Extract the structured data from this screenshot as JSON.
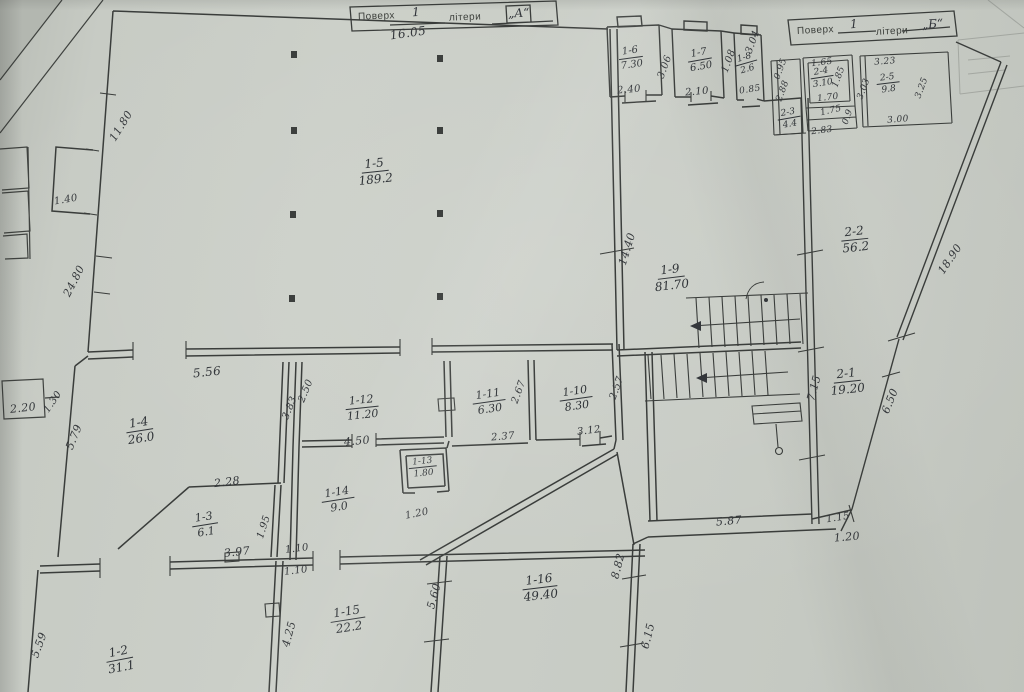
{
  "meta": {
    "document_type": "scanned floor plan",
    "paper_color": "#c9cdc6",
    "ink_color": "#34373b"
  },
  "title_blocks": [
    {
      "floor_label": "Поверх",
      "floor_value": "1",
      "letter_label": "літери",
      "letter_value": "„А“"
    },
    {
      "floor_label": "Поверх",
      "floor_value": "1",
      "letter_label": "літери",
      "letter_value": "„Б“"
    }
  ],
  "rooms": [
    {
      "id": "1-5",
      "area": "189.2",
      "x": 375,
      "y": 172,
      "rot": -6,
      "fs": 12
    },
    {
      "id": "1-6",
      "area": "7.30",
      "x": 631,
      "y": 58,
      "rot": -8,
      "fs": 10
    },
    {
      "id": "1-7",
      "area": "6.50",
      "x": 700,
      "y": 60,
      "rot": -10,
      "fs": 10
    },
    {
      "id": "1-8",
      "area": "2.6",
      "x": 746,
      "y": 64,
      "rot": -16,
      "fs": 9
    },
    {
      "id": "1-9",
      "area": "81.70",
      "x": 671,
      "y": 278,
      "rot": -7,
      "fs": 12
    },
    {
      "id": "2-2",
      "area": "56.2",
      "x": 855,
      "y": 240,
      "rot": -6,
      "fs": 12
    },
    {
      "id": "2-1",
      "area": "19.20",
      "x": 847,
      "y": 382,
      "rot": -6,
      "fs": 12
    },
    {
      "id": "2-3",
      "area": "4.4",
      "x": 789,
      "y": 119,
      "rot": -10,
      "fs": 9
    },
    {
      "id": "2-4",
      "area": "3.10",
      "x": 822,
      "y": 78,
      "rot": -9,
      "fs": 9
    },
    {
      "id": "2-5",
      "area": "9.8",
      "x": 888,
      "y": 84,
      "rot": -7,
      "fs": 9
    },
    {
      "id": "1-4",
      "area": "26.0",
      "x": 140,
      "y": 431,
      "rot": -9,
      "fs": 12
    },
    {
      "id": "1-12",
      "area": "11.20",
      "x": 362,
      "y": 408,
      "rot": -6,
      "fs": 11
    },
    {
      "id": "1-11",
      "area": "6.30",
      "x": 489,
      "y": 402,
      "rot": -8,
      "fs": 11
    },
    {
      "id": "1-10",
      "area": "8.30",
      "x": 576,
      "y": 399,
      "rot": -8,
      "fs": 11
    },
    {
      "id": "1-13",
      "area": "1.80",
      "x": 423,
      "y": 468,
      "rot": -6,
      "fs": 9
    },
    {
      "id": "1-14",
      "area": "9.0",
      "x": 338,
      "y": 500,
      "rot": -9,
      "fs": 11
    },
    {
      "id": "1-3",
      "area": "6.1",
      "x": 205,
      "y": 525,
      "rot": -9,
      "fs": 11
    },
    {
      "id": "1-2",
      "area": "31.1",
      "x": 120,
      "y": 660,
      "rot": -11,
      "fs": 12
    },
    {
      "id": "1-15",
      "area": "22.2",
      "x": 348,
      "y": 620,
      "rot": -9,
      "fs": 12
    },
    {
      "id": "1-16",
      "area": "49.40",
      "x": 540,
      "y": 588,
      "rot": -7,
      "fs": 12
    }
  ],
  "dimensions": [
    {
      "text": "16.05",
      "x": 408,
      "y": 33,
      "rot": -8,
      "fs": 12
    },
    {
      "text": "11.80",
      "x": 121,
      "y": 126,
      "rot": -58,
      "fs": 11
    },
    {
      "text": "1.40",
      "x": 66,
      "y": 200,
      "rot": -10,
      "fs": 10
    },
    {
      "text": "24.80",
      "x": 74,
      "y": 281,
      "rot": -63,
      "fs": 11
    },
    {
      "text": "2.20",
      "x": 23,
      "y": 408,
      "rot": -6,
      "fs": 11
    },
    {
      "text": "1.30",
      "x": 53,
      "y": 402,
      "rot": -55,
      "fs": 10
    },
    {
      "text": "5.79",
      "x": 74,
      "y": 437,
      "rot": -68,
      "fs": 11
    },
    {
      "text": "5.56",
      "x": 207,
      "y": 372,
      "rot": -6,
      "fs": 12
    },
    {
      "text": "3.83",
      "x": 290,
      "y": 408,
      "rot": -68,
      "fs": 10
    },
    {
      "text": "2.50",
      "x": 306,
      "y": 391,
      "rot": -68,
      "fs": 10
    },
    {
      "text": "4.50",
      "x": 357,
      "y": 441,
      "rot": -5,
      "fs": 11
    },
    {
      "text": "2.28",
      "x": 227,
      "y": 482,
      "rot": -7,
      "fs": 11
    },
    {
      "text": "1.95",
      "x": 264,
      "y": 527,
      "rot": -72,
      "fs": 10
    },
    {
      "text": "3.97",
      "x": 237,
      "y": 552,
      "rot": -6,
      "fs": 11
    },
    {
      "text": "1.10",
      "x": 297,
      "y": 549,
      "rot": -7,
      "fs": 10
    },
    {
      "text": "1.10",
      "x": 296,
      "y": 571,
      "rot": -7,
      "fs": 10
    },
    {
      "text": "1.20",
      "x": 417,
      "y": 514,
      "rot": -11,
      "fs": 10
    },
    {
      "text": "2.37",
      "x": 503,
      "y": 437,
      "rot": -5,
      "fs": 10
    },
    {
      "text": "3.12",
      "x": 589,
      "y": 431,
      "rot": -7,
      "fs": 10
    },
    {
      "text": "2.67",
      "x": 519,
      "y": 392,
      "rot": -70,
      "fs": 10
    },
    {
      "text": "2.57",
      "x": 617,
      "y": 388,
      "rot": -70,
      "fs": 10
    },
    {
      "text": "14.40",
      "x": 627,
      "y": 249,
      "rot": -73,
      "fs": 11
    },
    {
      "text": "2.40",
      "x": 629,
      "y": 90,
      "rot": -5,
      "fs": 10
    },
    {
      "text": "3.06",
      "x": 665,
      "y": 67,
      "rot": -70,
      "fs": 10
    },
    {
      "text": "2.10",
      "x": 697,
      "y": 92,
      "rot": -5,
      "fs": 10
    },
    {
      "text": "1.08",
      "x": 729,
      "y": 61,
      "rot": -70,
      "fs": 10
    },
    {
      "text": "3.04",
      "x": 753,
      "y": 42,
      "rot": -70,
      "fs": 10
    },
    {
      "text": "0.85",
      "x": 750,
      "y": 90,
      "rot": -9,
      "fs": 9
    },
    {
      "text": "0.95",
      "x": 781,
      "y": 69,
      "rot": -70,
      "fs": 9
    },
    {
      "text": "2.88",
      "x": 783,
      "y": 91,
      "rot": -70,
      "fs": 9
    },
    {
      "text": "1.65",
      "x": 822,
      "y": 63,
      "rot": -7,
      "fs": 9
    },
    {
      "text": "1.85",
      "x": 839,
      "y": 77,
      "rot": -70,
      "fs": 9
    },
    {
      "text": "1.70",
      "x": 828,
      "y": 98,
      "rot": -7,
      "fs": 9
    },
    {
      "text": "1.75",
      "x": 831,
      "y": 111,
      "rot": -13,
      "fs": 9
    },
    {
      "text": "0.9",
      "x": 848,
      "y": 117,
      "rot": -70,
      "fs": 9
    },
    {
      "text": "2.83",
      "x": 822,
      "y": 131,
      "rot": -7,
      "fs": 9
    },
    {
      "text": "3.23",
      "x": 885,
      "y": 62,
      "rot": -5,
      "fs": 9
    },
    {
      "text": "3.03",
      "x": 864,
      "y": 89,
      "rot": -70,
      "fs": 9
    },
    {
      "text": "3.25",
      "x": 922,
      "y": 88,
      "rot": -70,
      "fs": 9
    },
    {
      "text": "3.00",
      "x": 898,
      "y": 120,
      "rot": -5,
      "fs": 9
    },
    {
      "text": "18.90",
      "x": 950,
      "y": 259,
      "rot": -56,
      "fs": 11
    },
    {
      "text": "7.15",
      "x": 814,
      "y": 388,
      "rot": -75,
      "fs": 11
    },
    {
      "text": "6.50",
      "x": 890,
      "y": 401,
      "rot": -68,
      "fs": 11
    },
    {
      "text": "5.87",
      "x": 729,
      "y": 521,
      "rot": -5,
      "fs": 11
    },
    {
      "text": "1.15",
      "x": 838,
      "y": 518,
      "rot": -9,
      "fs": 10
    },
    {
      "text": "1.20",
      "x": 847,
      "y": 537,
      "rot": -5,
      "fs": 11
    },
    {
      "text": "5.59",
      "x": 39,
      "y": 645,
      "rot": -70,
      "fs": 11
    },
    {
      "text": "4.25",
      "x": 289,
      "y": 634,
      "rot": -75,
      "fs": 11
    },
    {
      "text": "5.60",
      "x": 434,
      "y": 596,
      "rot": -75,
      "fs": 11
    },
    {
      "text": "8.82",
      "x": 618,
      "y": 566,
      "rot": -76,
      "fs": 11
    },
    {
      "text": "6.15",
      "x": 648,
      "y": 636,
      "rot": -76,
      "fs": 11
    }
  ]
}
